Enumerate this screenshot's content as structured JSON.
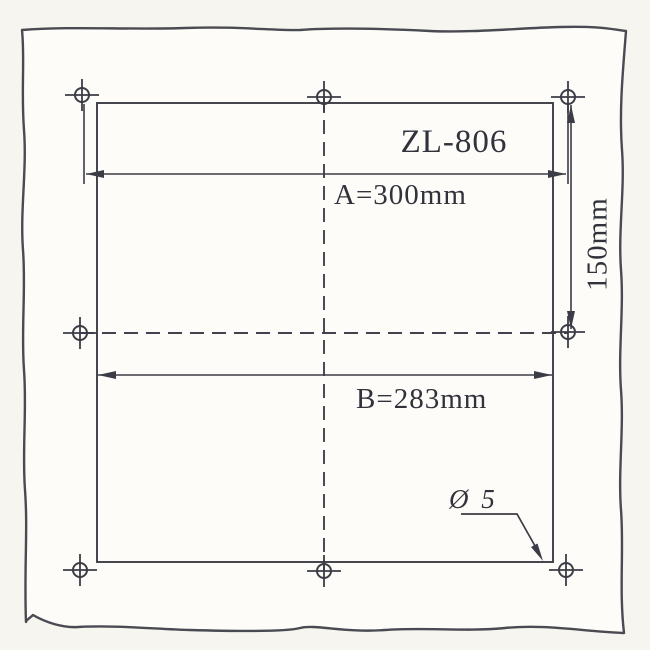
{
  "colors": {
    "ink": "#3c3c46",
    "paper": "#fdfcf8",
    "backdrop": "#f6f5ef",
    "text": "#32323c"
  },
  "drawing": {
    "model": "ZL-806",
    "dim_a": "A=300mm",
    "dim_b": "B=283mm",
    "dim_height": "150mm",
    "hole_callout": "Ø 5"
  },
  "diagram_data": {
    "type": "installation-drilling-template",
    "model": "ZL-806",
    "horizontal_hole_spacing_mm": 300,
    "cutout_width_mm": 283,
    "vertical_hole_spacing_mm": 150,
    "hole_diameter_mm": 5,
    "hole_marker_count": 8,
    "style": "scanned hand-drawn technical sketch, dashed centerlines, outward dimension arrows"
  }
}
